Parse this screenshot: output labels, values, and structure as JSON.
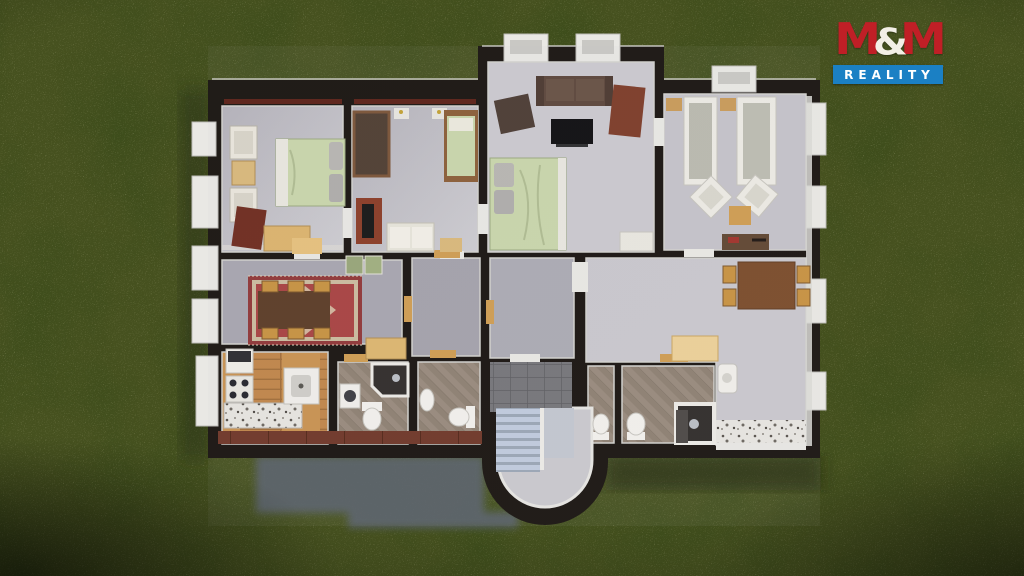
{
  "logo": {
    "m1": "M",
    "amp": "&",
    "m2": "M",
    "tagline": "REALITY",
    "red": "#c01f26",
    "blue": "#1b80c4",
    "white": "#ffffff"
  },
  "scene": {
    "type": "3d-floorplan-top-view-render",
    "colors": {
      "grass_green": "#46511f",
      "wall_black": "#17120e",
      "floor_gray": "#c2c0c6",
      "wood_floor": "#c08548",
      "bathroom_tile": "#97897b",
      "duvet_green": "#c9d6ab",
      "rug_red": "#a84140",
      "house_shadow": "#5a616b",
      "stair_blue_gray": "#b9c3d5"
    },
    "rooms": [
      "bedroom-1",
      "bedroom-2",
      "living-room",
      "twin-bedroom",
      "dining-room",
      "hall-room-a",
      "hall-room-b",
      "great-room",
      "kitchen",
      "bathroom-1",
      "bathroom-2",
      "entry-stairwell",
      "wc",
      "bathroom-3"
    ]
  }
}
